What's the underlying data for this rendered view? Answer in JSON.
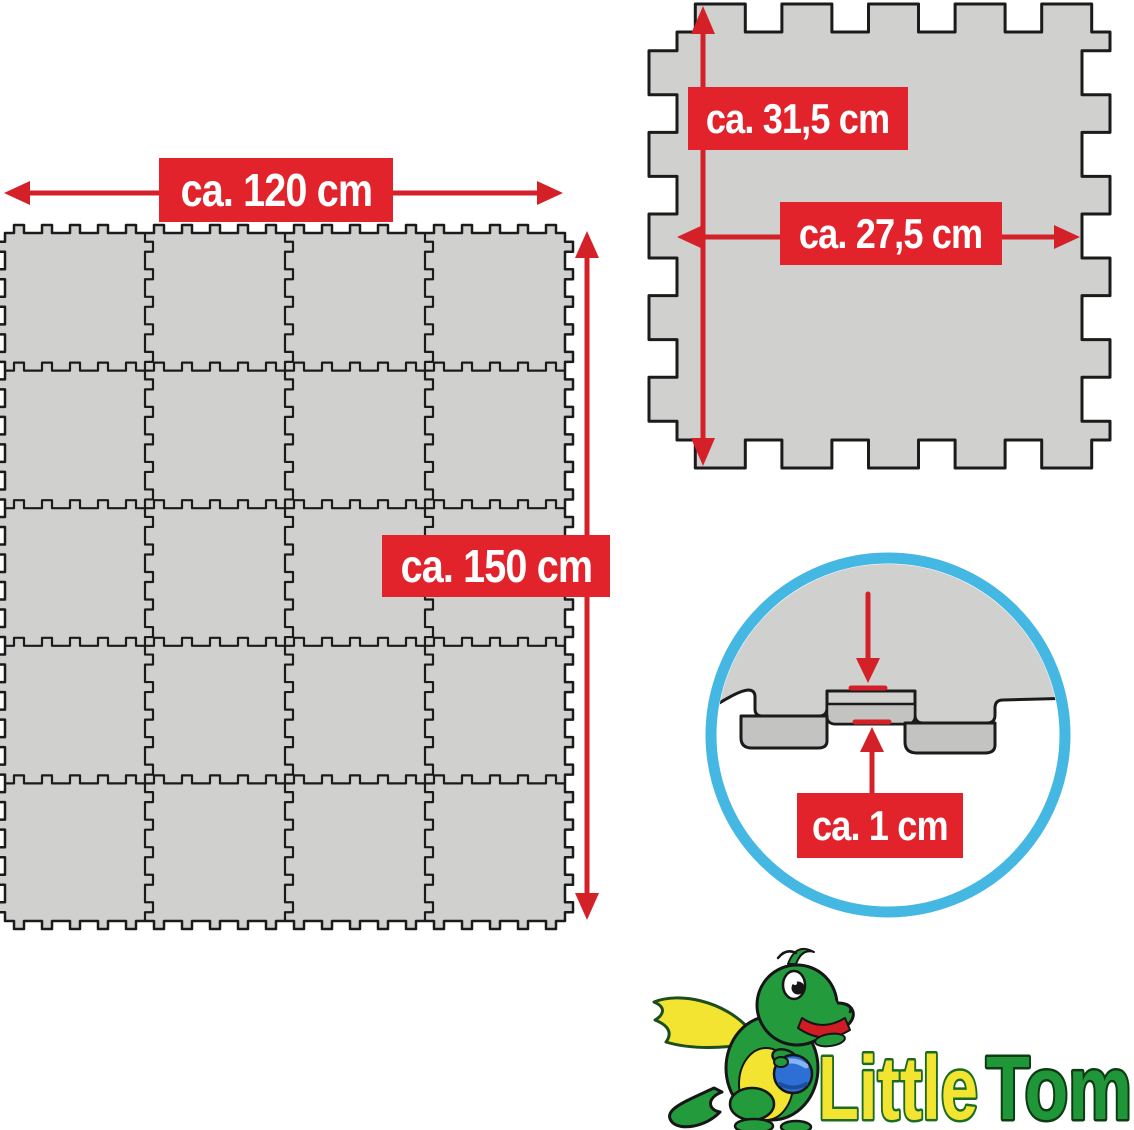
{
  "product_image": {
    "type": "foam-puzzle-play-mat-dimension-diagram",
    "background": "#ffffff"
  },
  "mat_grid": {
    "width_label": "ca. 120 cm",
    "height_label": "ca. 150 cm",
    "columns": 4,
    "rows": 5,
    "tile_count": 20
  },
  "single_tile": {
    "height_label": "ca. 31,5 cm",
    "width_label": "ca. 27,5 cm"
  },
  "thickness_detail": {
    "label": "ca. 1 cm"
  },
  "brand": {
    "word1": "Little",
    "word2": "Tom"
  },
  "colors": {
    "label_red": "#e3232b",
    "arrow_red": "#d42128",
    "mat_fill": "#d0d0cf",
    "mat_edge_fill": "#c3c3c1",
    "mat_stroke": "#1b1b1b",
    "circle_ring": "#45b7e3",
    "logo_yellow": "#f2e430",
    "logo_green": "#1f9638",
    "dragon_green": "#239b3d",
    "ball_blue": "#2e6fd6"
  }
}
